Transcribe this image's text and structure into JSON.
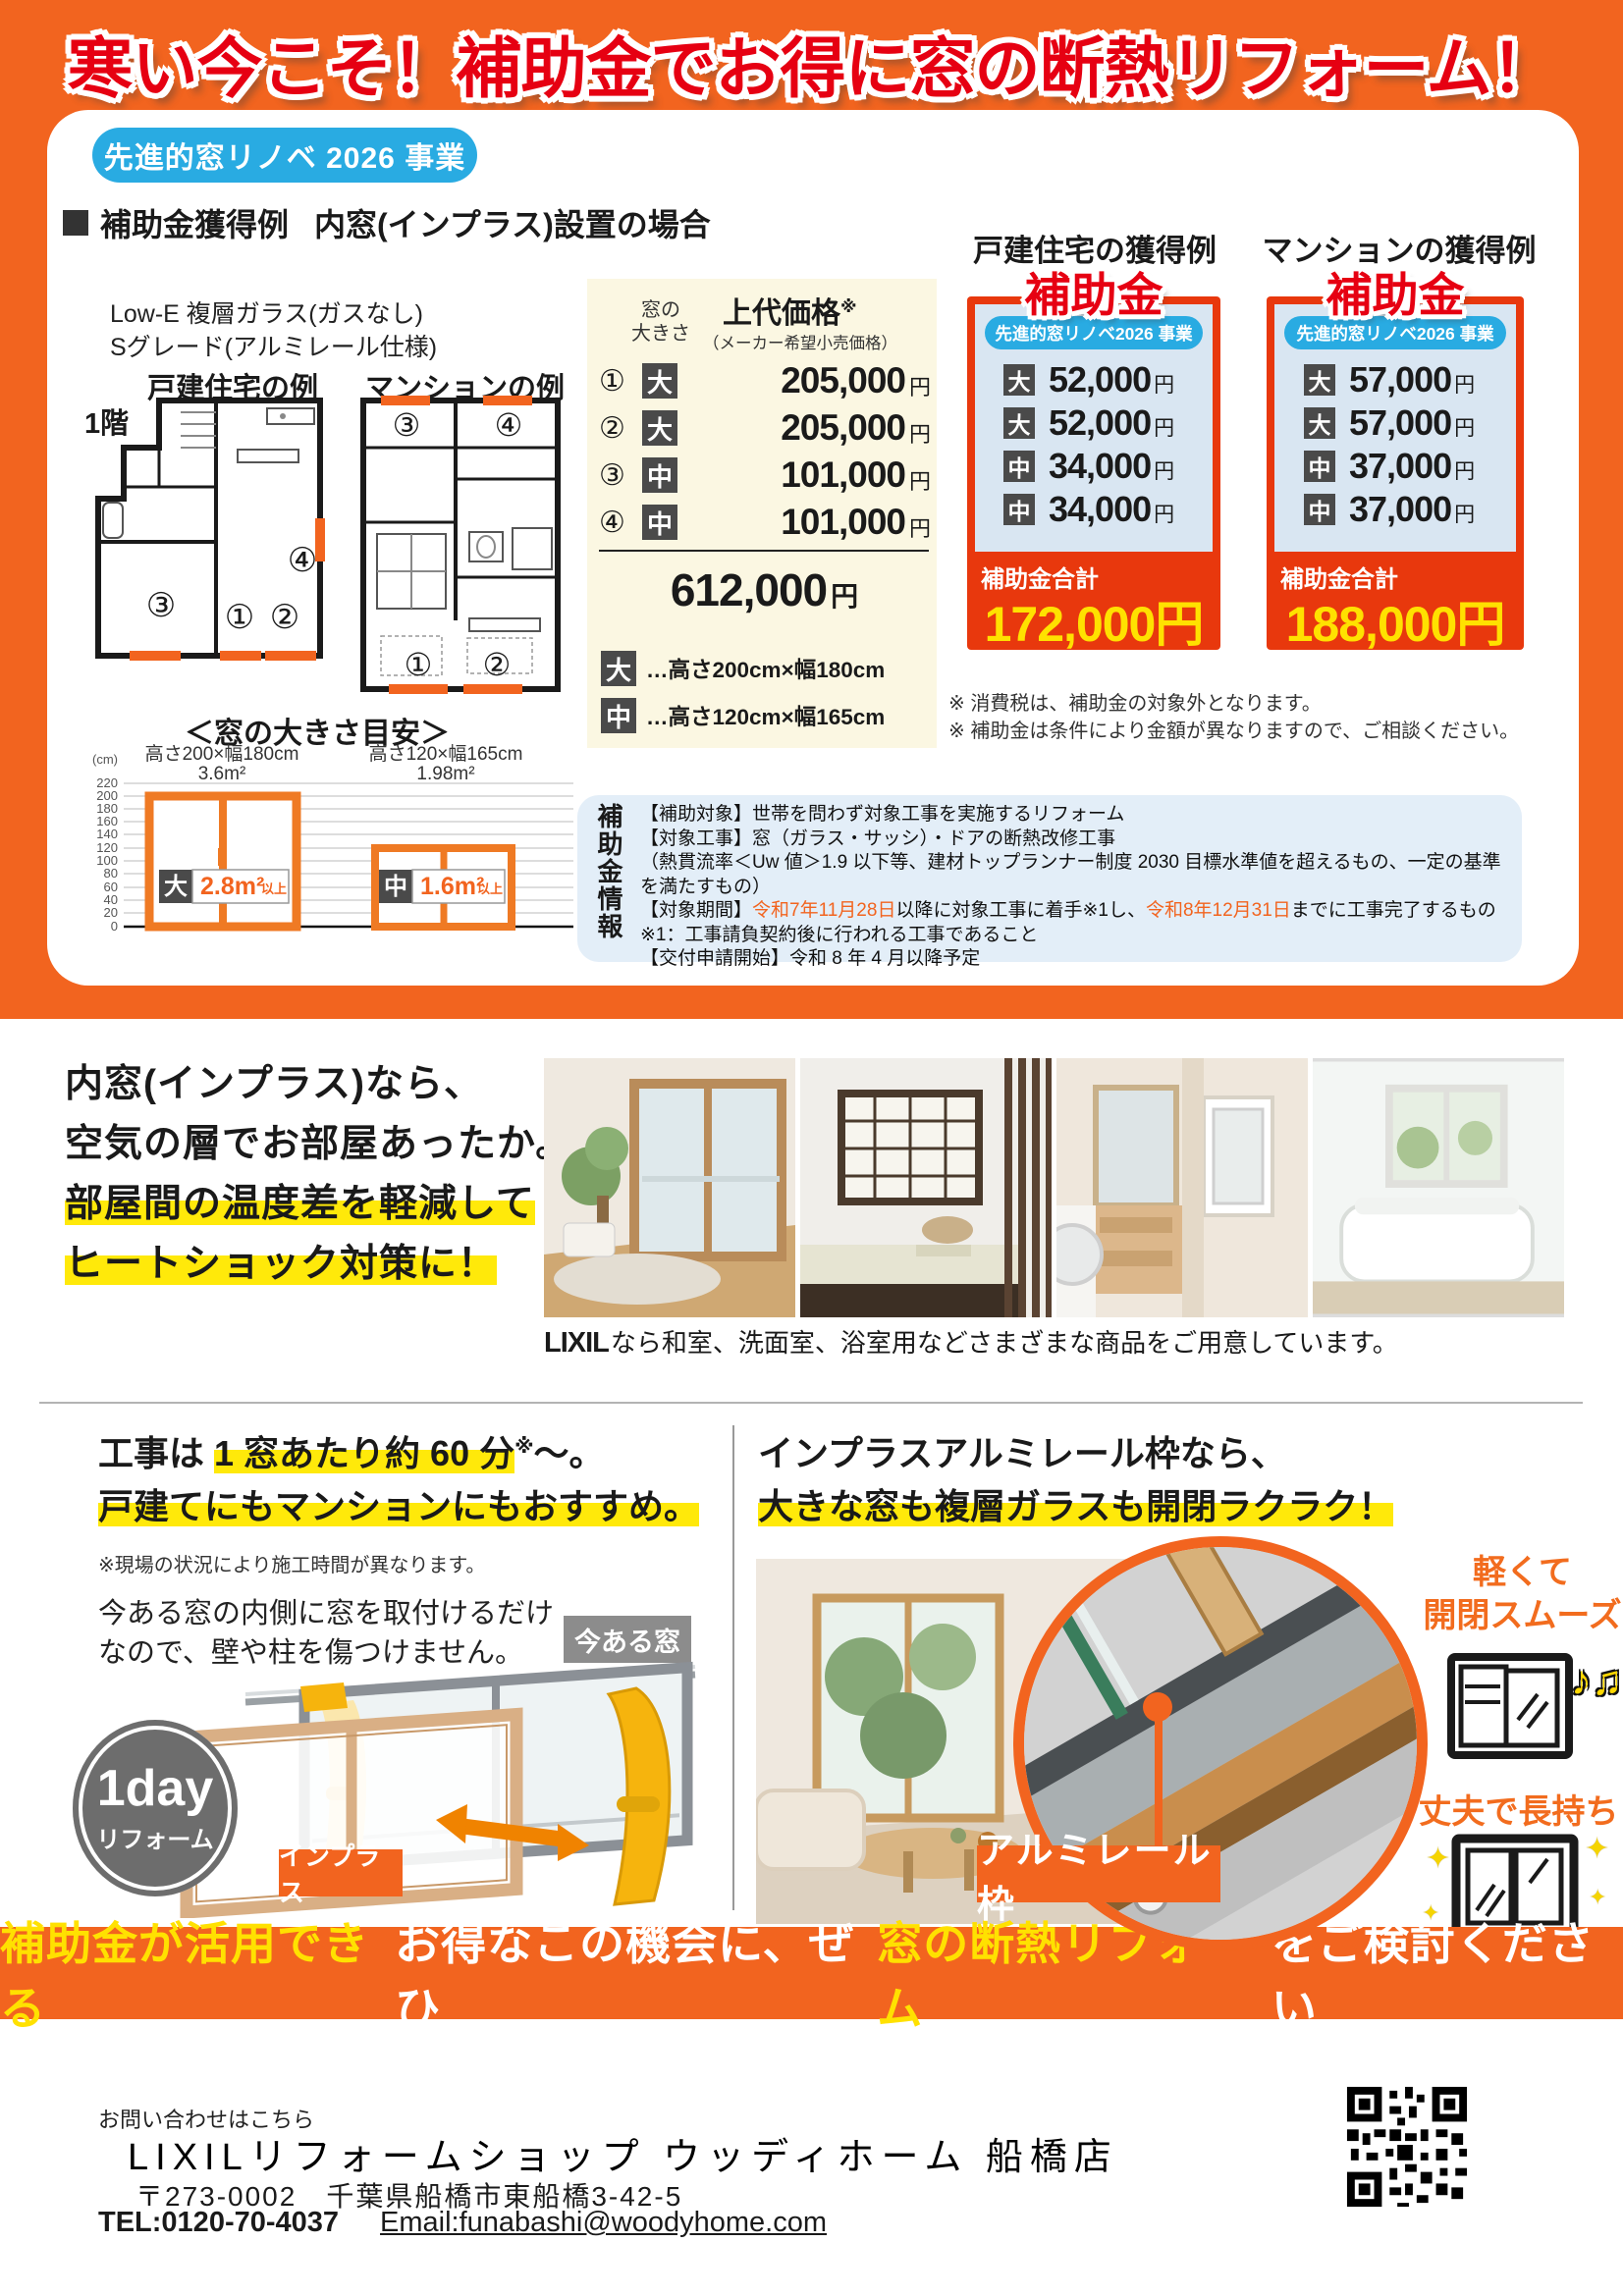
{
  "yen": "円",
  "colors": {
    "orange": "#f2641f",
    "panel_red": "#e8380d",
    "title_red": "#e60012",
    "badge_blue": "#29abe2",
    "cream": "#fbf7e2",
    "panel_blue": "#d9e6f2",
    "chip_gray": "#4a4a4a",
    "total_yellow": "#ffe100",
    "highlight_yellow": "#ffe90a"
  },
  "top_banner": {
    "title": "寒い今こそ！補助金でお得に窓の断熱リフォーム！"
  },
  "program": {
    "badge": "先進的窓リノベ 2026 事業"
  },
  "example": {
    "heading": "補助金獲得例",
    "heading_sub": "内窓(インプラス)設置の場合",
    "spec_line1": "Low-E 複層ガラス(ガスなし)",
    "spec_line2": "Sグレード(アルミレール仕様)",
    "house_label": "戸建住宅の例",
    "floor_label": "1階",
    "mansion_label": "マンションの例"
  },
  "plan_numbers": {
    "n1": "①",
    "n2": "②",
    "n3": "③",
    "n4": "④"
  },
  "price_table": {
    "size_col_line1": "窓の",
    "size_col_line2": "大きさ",
    "price_col": "上代価格",
    "price_mark": "※",
    "price_sub": "（メーカー希望小売価格）",
    "rows": [
      {
        "no": "①",
        "size": "大",
        "amount": "205,000"
      },
      {
        "no": "②",
        "size": "大",
        "amount": "205,000"
      },
      {
        "no": "③",
        "size": "中",
        "amount": "101,000"
      },
      {
        "no": "④",
        "size": "中",
        "amount": "101,000"
      }
    ],
    "total": "612,000",
    "legend": [
      {
        "size": "大",
        "text": "…高さ200cm×幅180cm"
      },
      {
        "size": "中",
        "text": "…高さ120cm×幅165cm"
      }
    ]
  },
  "panels": [
    {
      "heading": "戸建住宅の獲得例",
      "label": "補助金",
      "badge": "先進的窓リノベ2026 事業",
      "rows": [
        {
          "size": "大",
          "amount": "52,000"
        },
        {
          "size": "大",
          "amount": "52,000"
        },
        {
          "size": "中",
          "amount": "34,000"
        },
        {
          "size": "中",
          "amount": "34,000"
        }
      ],
      "total_label": "補助金合計",
      "total": "172,000円"
    },
    {
      "heading": "マンションの獲得例",
      "label": "補助金",
      "badge": "先進的窓リノベ2026 事業",
      "rows": [
        {
          "size": "大",
          "amount": "57,000"
        },
        {
          "size": "大",
          "amount": "57,000"
        },
        {
          "size": "中",
          "amount": "37,000"
        },
        {
          "size": "中",
          "amount": "37,000"
        }
      ],
      "total_label": "補助金合計",
      "total": "188,000円"
    }
  ],
  "notes": {
    "line1": "※ 消費税は、補助金の対象外となります。",
    "line2": "※ 補助金は条件により金額が異なりますので、ご相談ください。"
  },
  "size_guide": {
    "title": "＜窓の大きさ目安＞",
    "unit": "(cm)",
    "ticks": [
      220,
      200,
      180,
      160,
      140,
      120,
      100,
      80,
      60,
      40,
      20,
      0
    ],
    "large": {
      "dims": "高さ200×幅180cm",
      "area": "3.6m²",
      "chip": "大",
      "min": "2.8m²",
      "suffix": "以上"
    },
    "medium": {
      "dims": "高さ120×幅165cm",
      "area": "1.98m²",
      "chip": "中",
      "min": "1.6m²",
      "suffix": "以上"
    }
  },
  "info": {
    "vertical_title": "補助金情報",
    "line1": "【補助対象】世帯を問わず対象工事を実施するリフォーム",
    "line2": "【対象工事】窓（ガラス・サッシ）・ドアの断熱改修工事",
    "line3": "（熱貫流率＜Uw 値＞1.9 以下等、建材トップランナー制度 2030 目標水準値を超えるもの、一定の基準を満たすもの）",
    "line4_prefix": "【対象期間】",
    "line4_date1": "令和7年11月28日",
    "line4_mid": "以降に対象工事に着手※1し、",
    "line4_date2": "令和8年12月31日",
    "line4_suffix": "までに工事完了するもの",
    "line5": "※1：工事請負契約後に行われる工事であること",
    "line6": "【交付申請開始】令和 8 年 4 月以降予定"
  },
  "benefit": {
    "line1": "内窓(インプラス)なら、",
    "line2": "空気の層でお部屋あったか。",
    "line3": "部屋間の温度差を軽減して",
    "line4": "ヒートショック対策に！",
    "caption_logo": "LIXIL",
    "caption": "なら和室、洗面室、浴室用などさまざまな商品をご用意しています。"
  },
  "construction": {
    "h1_pre": "工事は ",
    "h1_hl": "1 窓あたり約 60 分",
    "h1_mark": "※",
    "h1_post": "〜。",
    "h2": "戸建てにもマンションにもおすすめ。",
    "note": "※現場の状況により施工時間が異なります。",
    "body1": "今ある窓の内側に窓を取付けるだけ",
    "body2": "なので、壁や柱を傷つけません。",
    "tag_existing": "今ある窓",
    "tag_inner": "インプラス",
    "day1": "1day",
    "day2": "リフォーム"
  },
  "rail": {
    "h1": "インプラスアルミレール枠なら、",
    "h2": "大きな窓も複層ガラスも開閉ラクラク！",
    "label": "アルミレール枠",
    "f1a": "軽くて",
    "f1b": "開閉スムーズ",
    "f2": "丈夫で長持ち",
    "music": "♪♫",
    "sparkle": "✦"
  },
  "banner_bottom": {
    "part1": "補助金が活用できる",
    "part2": "お得なこの機会に、ぜひ",
    "part3": "窓の断熱リフォーム",
    "part4": "をご検討ください"
  },
  "footer": {
    "contact": "お問い合わせはこちら",
    "company": "LIXILリフォームショップ ウッディホーム 船橋店",
    "address": "〒273-0002　千葉県船橋市東船橋3-42-5",
    "tel": "TEL:0120-70-4037",
    "email": "Email:funabashi@woodyhome.com"
  }
}
